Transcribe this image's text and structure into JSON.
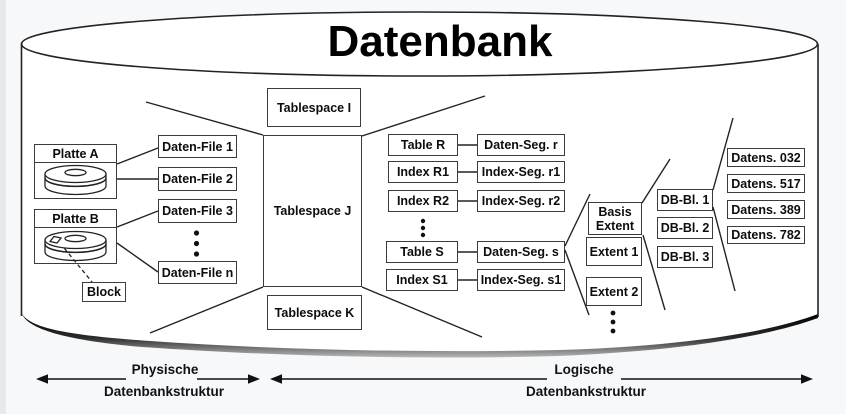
{
  "title": "Datenbank",
  "physical_structure": {
    "disk_a": "Platte A",
    "disk_b": "Platte B",
    "block": "Block",
    "files": [
      "Daten-File 1",
      "Daten-File 2",
      "Daten-File 3",
      "Daten-File n"
    ]
  },
  "tablespaces": [
    "Tablespace I",
    "Tablespace J",
    "Tablespace K"
  ],
  "logical_objects": [
    {
      "object": "Table R",
      "segment": "Daten-Seg. r"
    },
    {
      "object": "Index R1",
      "segment": "Index-Seg. r1"
    },
    {
      "object": "Index R2",
      "segment": "Index-Seg. r2"
    },
    {
      "object": "Table S",
      "segment": "Daten-Seg. s"
    },
    {
      "object": "Index S1",
      "segment": "Index-Seg. s1"
    }
  ],
  "extents": [
    "Basis Extent",
    "Extent 1",
    "Extent 2"
  ],
  "db_blocks": [
    "DB-Bl. 1",
    "DB-Bl. 2",
    "DB-Bl. 3"
  ],
  "records": [
    "Datens. 032",
    "Datens. 517",
    "Datens. 389",
    "Datens. 782"
  ],
  "legend": {
    "physical": {
      "line1": "Physische",
      "line2": "Datenbankstruktur"
    },
    "logical": {
      "line1": "Logische",
      "line2": "Datenbankstruktur"
    }
  }
}
